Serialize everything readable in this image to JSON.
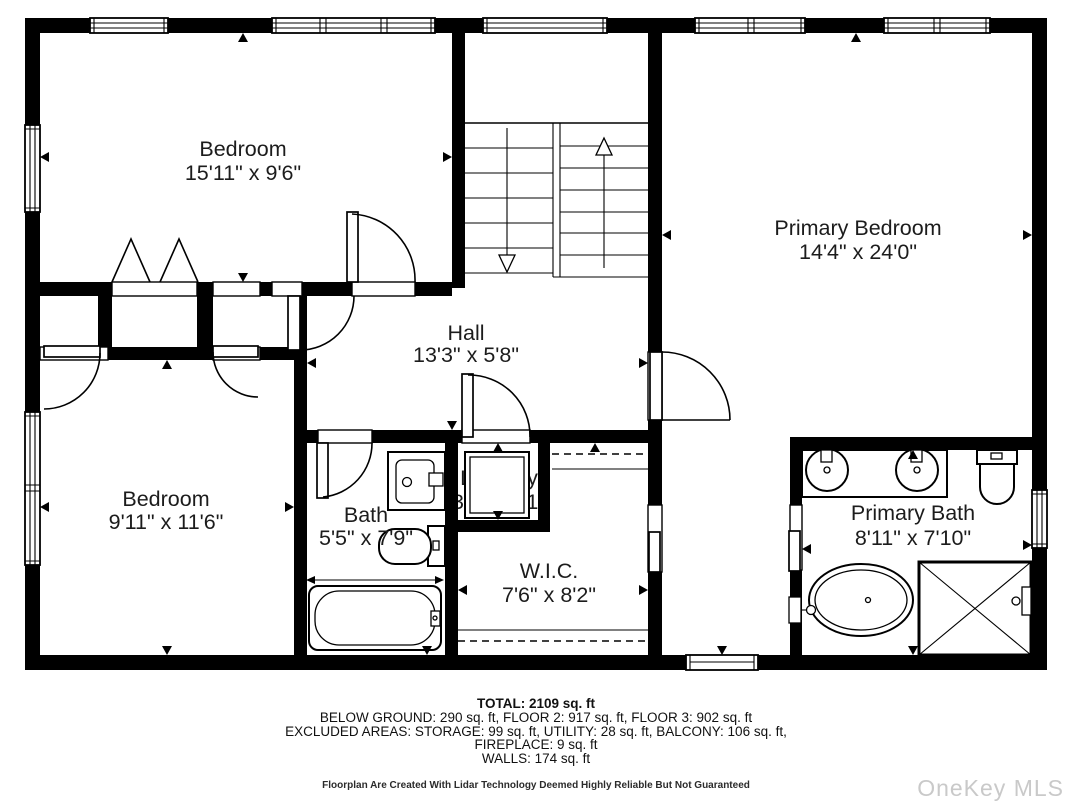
{
  "plan": {
    "rooms": [
      {
        "id": "bedroom-1",
        "name": "Bedroom",
        "dims": "15'11\" x 9'6\""
      },
      {
        "id": "primary-bedroom",
        "name": "Primary Bedroom",
        "dims": "14'4\" x 24'0\""
      },
      {
        "id": "hall",
        "name": "Hall",
        "dims": "13'3\" x 5'8\""
      },
      {
        "id": "bedroom-2",
        "name": "Bedroom",
        "dims": "9'11\" x 11'6\""
      },
      {
        "id": "bath",
        "name": "Bath",
        "dims": "5'5\" x 7'9\""
      },
      {
        "id": "laundry",
        "name": "Laundry",
        "dims": "3'2\" x 3'1\""
      },
      {
        "id": "wic",
        "name": "W.I.C.",
        "dims": "7'6\" x 8'2\""
      },
      {
        "id": "primary-bath",
        "name": "Primary Bath",
        "dims": "8'11\" x 7'10\""
      }
    ],
    "colors": {
      "wall": "#000000",
      "background": "#ffffff",
      "text": "#1c1c1c",
      "watermark": "#c9c9c9"
    }
  },
  "summary": {
    "total": "TOTAL: 2109 sq. ft",
    "line2": "BELOW GROUND: 290 sq. ft, FLOOR 2: 917 sq. ft, FLOOR 3: 902 sq. ft",
    "line3": "EXCLUDED AREAS: STORAGE: 99 sq. ft, UTILITY: 28 sq. ft, BALCONY: 106 sq. ft,",
    "line4": "FIREPLACE: 9 sq. ft",
    "line5": "WALLS: 174 sq. ft"
  },
  "disclaimer": "Floorplan Are Created With Lidar Technology Deemed Highly Reliable But Not Guaranteed",
  "watermark": "OneKey MLS"
}
